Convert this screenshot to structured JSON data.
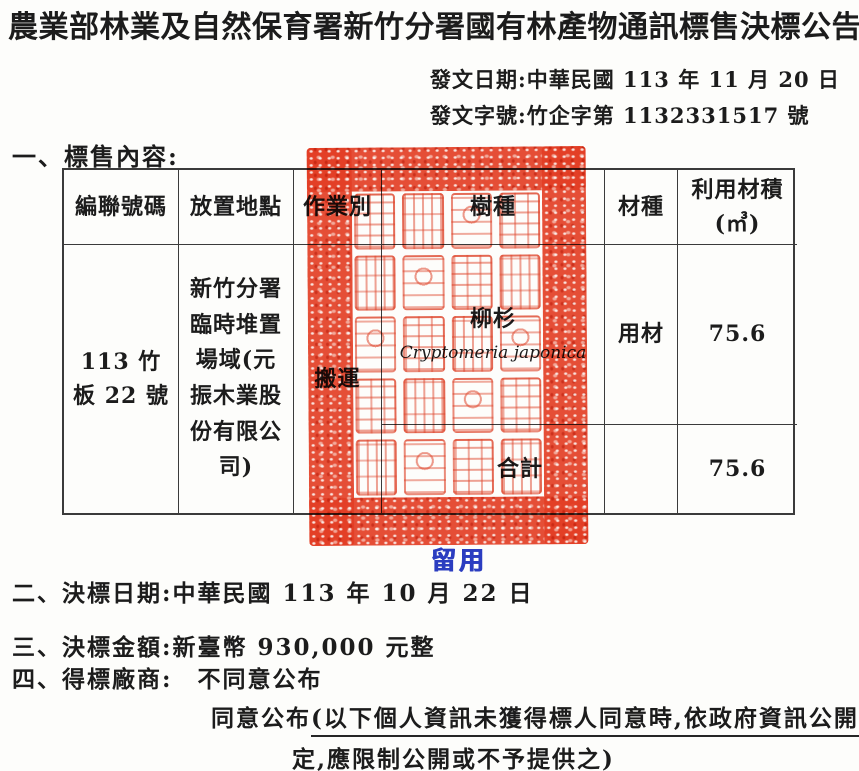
{
  "header": {
    "title": "農業部林業及自然保育署新竹分署國有林產物通訊標售決標公告",
    "issue_date": "發文日期:中華民國 113 年 11 月 20 日",
    "issue_number": "發文字號:竹企字第 1132331517 號"
  },
  "sale": {
    "heading": "一、標售內容:",
    "table": {
      "headers": {
        "serial": "編聯號碼",
        "location": "放置地點",
        "operation": "作業別",
        "species": "樹種",
        "material": "材種",
        "volume_line1": "利用材積",
        "volume_line2": "(㎥)"
      },
      "row": {
        "serial": "113 竹板 22 號",
        "location": "新竹分署臨時堆置場域(元振木業股份有限公司)",
        "operation": "搬運",
        "species_zh": "柳杉",
        "species_latin": "Cryptomeria japonica",
        "material": "用材",
        "volume": "75.6"
      },
      "total": {
        "label": "合計",
        "volume": "75.6"
      }
    }
  },
  "items": {
    "award_date": "二、決標日期:中華民國 113 年 10 月 22 日",
    "award_amount": "三、決標金額:新臺幣 930,000 元整",
    "winner_prefix": "四、得標廠商:",
    "winner_option_disagree": "不同意公布",
    "winner_option_agree": "同意公布",
    "winner_note_line1": "(以下個人資訊未獲得標人同意時,依政府資訊公開法第 18 條規",
    "winner_note_line2": "定,應限制公開或不予提供之)",
    "disagree_checked": true,
    "agree_checked": false
  },
  "seal": {
    "color": "#e53f26",
    "glyph_rows": 5,
    "glyph_cols": 4
  },
  "stamp": {
    "text": "留用",
    "color": "#2b3dc0"
  }
}
